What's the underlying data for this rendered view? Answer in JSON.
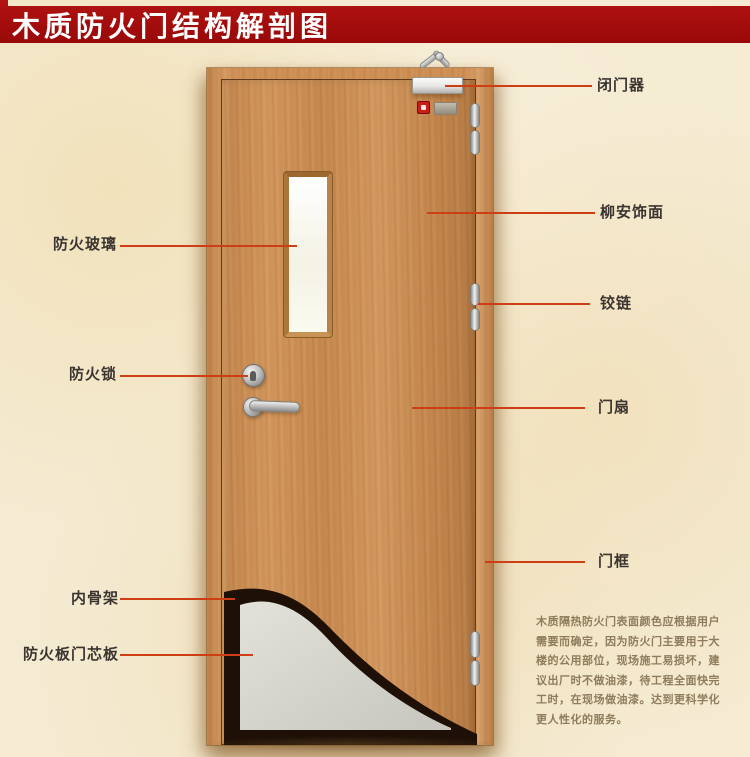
{
  "title": "木质防火门结构解剖图",
  "colors": {
    "banner_bg": "#9b0a0a",
    "banner_text": "#ffffff",
    "page_background": "#f4ebd2",
    "wood": "#cb8d53",
    "callout_line": "#ce3e15",
    "label_text": "#3b3531",
    "core_gray": "#d4d4cc",
    "skeleton_dark": "#1e1007",
    "glass_white": "#fbfaf1"
  },
  "labels": {
    "left": [
      {
        "id": "fire-glass",
        "text": "防火玻璃"
      },
      {
        "id": "fire-lock",
        "text": "防火锁"
      },
      {
        "id": "inner-skeleton",
        "text": "内骨架"
      },
      {
        "id": "core-board",
        "text": "防火板门芯板"
      }
    ],
    "right": [
      {
        "id": "door-closer",
        "text": "闭门器"
      },
      {
        "id": "veneer",
        "text": "柳安饰面"
      },
      {
        "id": "hinge",
        "text": "铰链"
      },
      {
        "id": "door-leaf",
        "text": "门扇"
      },
      {
        "id": "door-frame",
        "text": "门框"
      }
    ]
  },
  "description": "木质隔热防火门表面颜色应根据用户\n需要而确定，因为防火门主要用于大\n楼的公用部位，现场施工易损坏，建\n议出厂时不做油漆，待工程全面快完\n工时，在现场做油漆。达到更科学化\n更人性化的服务。"
}
